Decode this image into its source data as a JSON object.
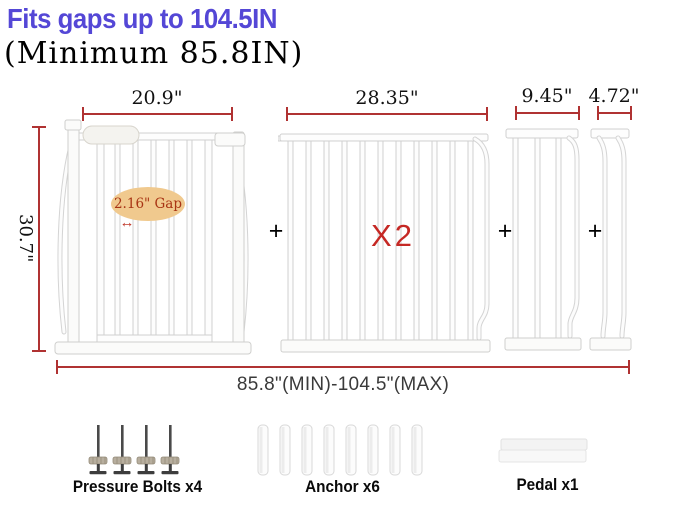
{
  "header": {
    "title": "Fits gaps up to 104.5IN",
    "subtitle": "(Minimum 85.8IN)"
  },
  "dimensions": {
    "height_label": "30.7\"",
    "total_label": "85.8\"(MIN)-104.5\"(MAX)",
    "gap": {
      "label": "2.16\" Gap",
      "arrow": "↔"
    }
  },
  "panels": [
    {
      "name": "pressure-mount-gate",
      "width_label": "20.9\""
    },
    {
      "name": "extension-panel-large",
      "width_label": "28.35\"",
      "multiplier": "X2"
    },
    {
      "name": "extension-panel-medium",
      "width_label": "9.45\""
    },
    {
      "name": "extension-panel-small",
      "width_label": "4.72\""
    }
  ],
  "plus_sign": "+",
  "parts": [
    {
      "label": "Pressure Bolts x4",
      "count": 4
    },
    {
      "label": "Anchor x6",
      "count": 6
    },
    {
      "label": "Pedal x1",
      "count": 1
    }
  ],
  "colors": {
    "title_blue": "#5447d6",
    "dimension_red": "#b03232",
    "multiplier_red": "#c52824",
    "gap_ellipse_fill": "#f0c98e",
    "gap_text": "#a83414",
    "label_black": "#0a0a0a",
    "total_text": "#3a3a3a"
  }
}
